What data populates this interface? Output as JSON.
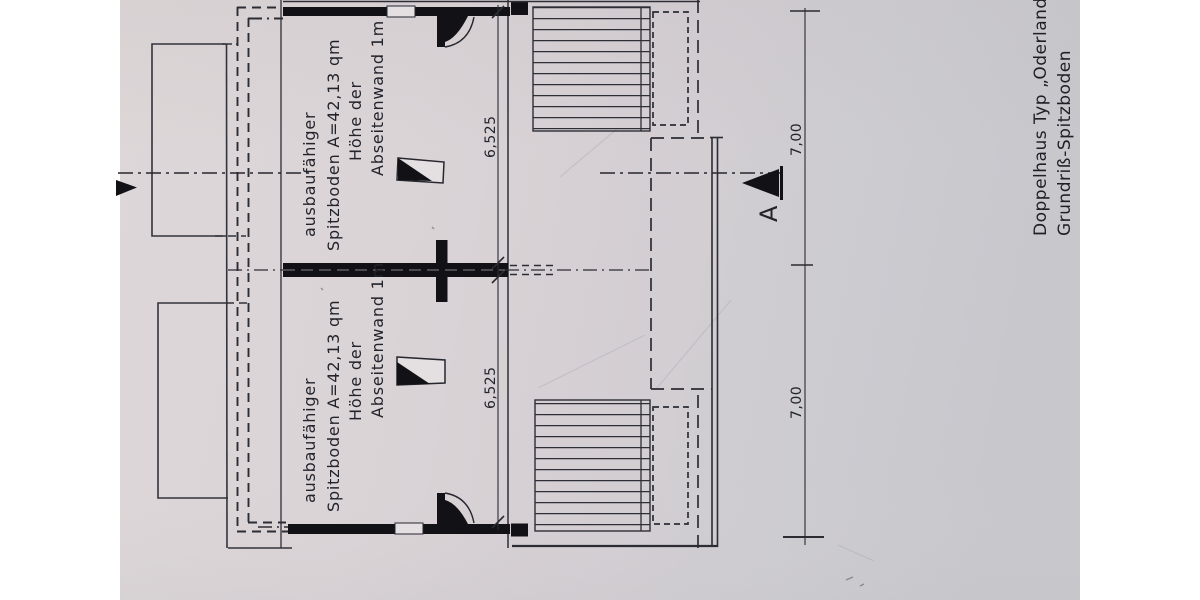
{
  "document": {
    "title_line1": "Doppelhaus Typ „Oderland“",
    "title_line2": "Grundriß-Spitzboden",
    "section_letter": "A"
  },
  "rooms": {
    "upper": {
      "line1": "ausbaufähiger",
      "line2": "Spitzboden A=42,13 qm",
      "line3": "Höhe der",
      "line4": "Abseitenwand 1m"
    },
    "lower": {
      "line1": "ausbaufähiger",
      "line2": "Spitzboden A=42,13 qm",
      "line3": "Höhe der",
      "line4": "Abseitenwand 1m"
    }
  },
  "dimensions": {
    "upper_inner_width": "6,525",
    "lower_inner_width": "6,525",
    "upper_outer_width": "7,00",
    "lower_outer_width": "7,00"
  },
  "colors": {
    "paper": "#d7d1d4",
    "ink": "#26262e",
    "wall": "#121216"
  }
}
